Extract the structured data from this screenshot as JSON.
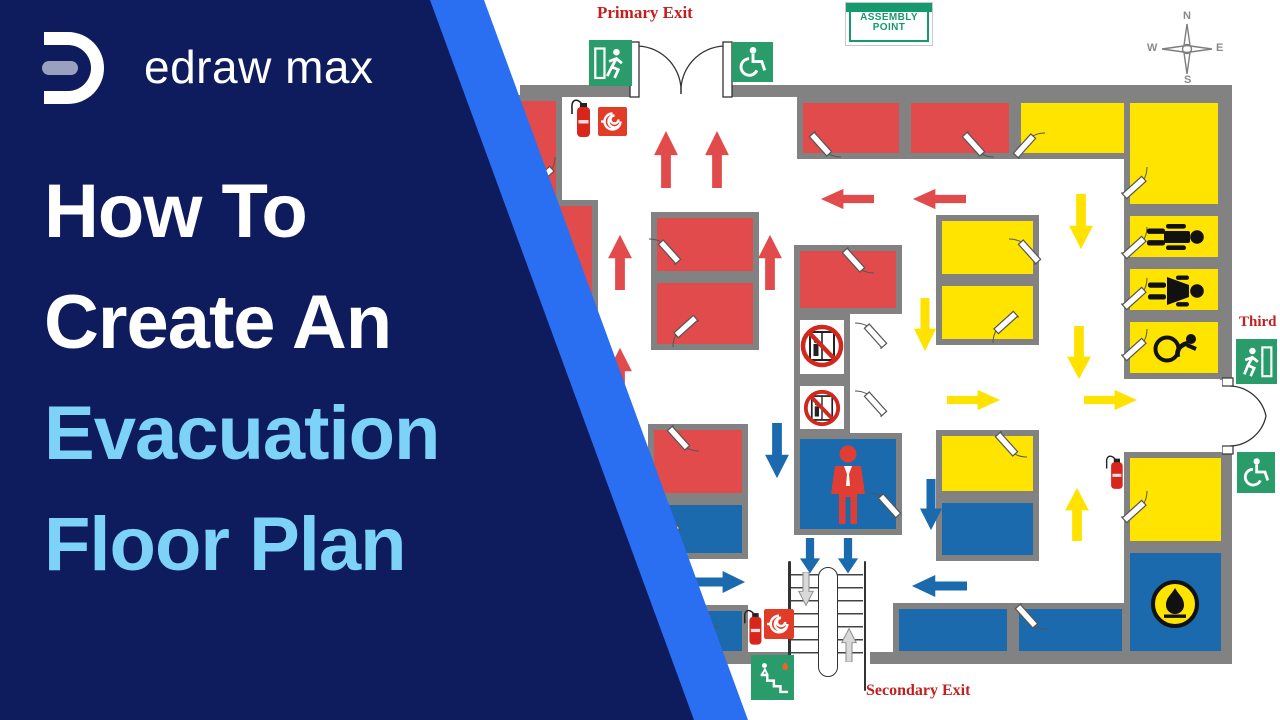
{
  "brand": {
    "name": "edraw max"
  },
  "title": {
    "lines": [
      "How To",
      "Create An",
      "Evacuation",
      "Floor Plan"
    ]
  },
  "plan": {
    "labels": {
      "primary_exit": "Primary Exit",
      "secondary_exit": "Secondary Exit",
      "third_exit": "Third"
    },
    "assembly": {
      "line1": "ASSEMBLY",
      "line2": "POINT"
    },
    "compass": {
      "n": "N",
      "e": "E",
      "s": "S",
      "w": "W"
    },
    "icons": {
      "exit_running_man": "green-exit-sign",
      "accessible_exit": "green-wheelchair-sign",
      "stairs_exit": "green-stairs-sign",
      "assembly_point": "green-assembly-board",
      "fire_extinguisher": "red-extinguisher",
      "fire_hose_reel": "white-spiral-on-red-square",
      "no_elevator": "elevator-with-red-prohibition-circle",
      "fire_warden": "red-person-figure",
      "mens_restroom": "male-figure",
      "womens_restroom": "female-figure",
      "accessible_restroom": "wheelchair-figure",
      "flammable": "black-flame-in-yellow-circle",
      "compass_rose": "four-point-star"
    },
    "palette": {
      "panel_navy": "#0e1c5e",
      "accent_blue": "#2a6ff1",
      "title_white": "#ffffff",
      "title_light_blue": "#7dd2f8",
      "room_red": "#e24b4b",
      "room_yellow": "#ffe400",
      "room_blue": "#1a6aad",
      "wall_gray": "#828282",
      "sign_green": "#2a9b6a",
      "label_red": "#c31f1f"
    }
  }
}
